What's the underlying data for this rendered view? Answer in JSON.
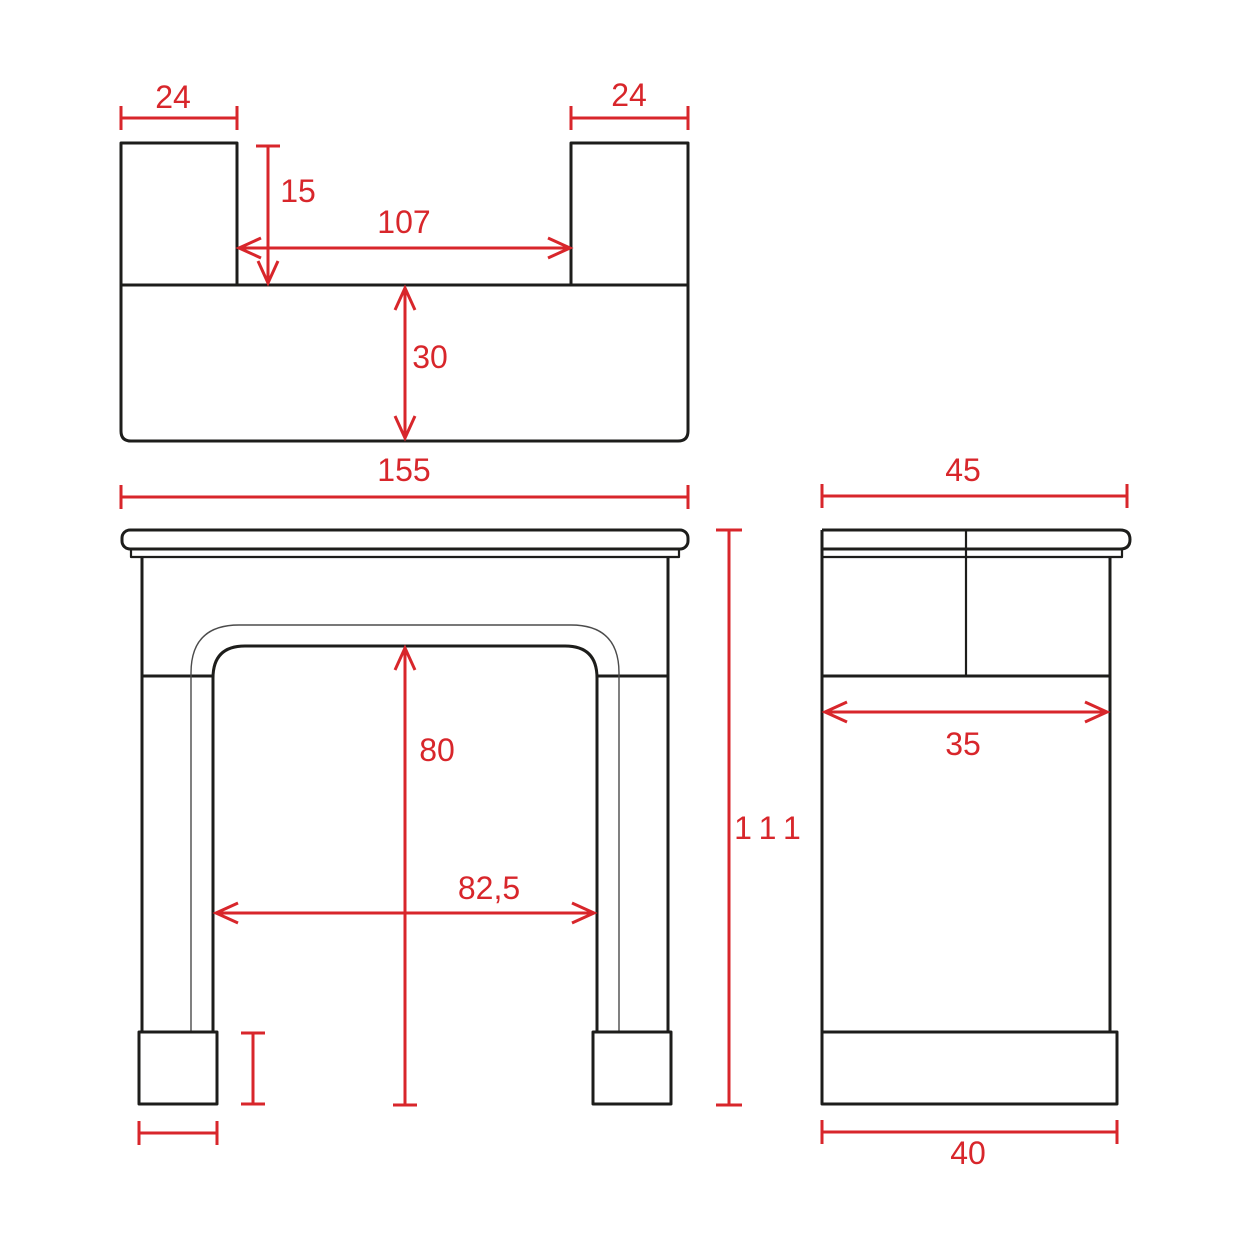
{
  "drawing": {
    "title": "Fireplace mantel three-view dimensioned drawing",
    "background": "#ffffff",
    "colors": {
      "outline": "#1d1d1b",
      "thin_line": "#4b4b4b",
      "dimension": "#d8262b"
    },
    "views": {
      "top": {
        "name": "top view (plan)",
        "dims": {
          "post_width_left": "24",
          "post_width_right": "24",
          "post_depth": "15",
          "inner_span": "107",
          "band_depth": "30"
        }
      },
      "front": {
        "name": "front view",
        "dims": {
          "overall_width": "155",
          "opening_height": "80",
          "opening_width": "82,5",
          "overall_height": "111"
        }
      },
      "side": {
        "name": "side view",
        "dims": {
          "shelf_depth": "45",
          "mid_depth": "35",
          "base_depth": "40"
        }
      }
    }
  }
}
